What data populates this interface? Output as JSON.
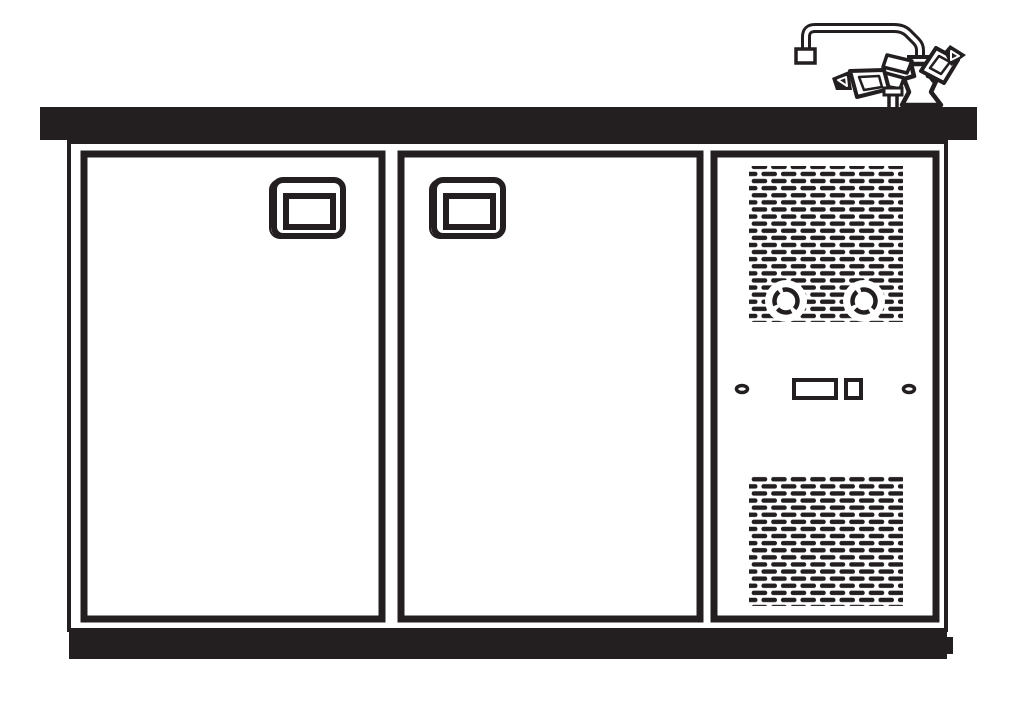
{
  "colors": {
    "ink": "#231f20",
    "paper": "#ffffff"
  },
  "components": {
    "diagram": "Technical line drawing of an under-counter back-bar cooler with sink faucet",
    "countertop": "Countertop",
    "faucet": "Gooseneck faucet with cross handles",
    "cabinet": "Cooler cabinet frame",
    "left_door": "Left cooler door",
    "left_door_handle": "Recessed door handle",
    "right_door": "Right cooler door",
    "right_door_handle": "Recessed door handle",
    "compressor_panel": "Compressor compartment front panel",
    "top_grille": "Upper ventilation grille",
    "knob_left": "Left control knob",
    "knob_right": "Right control knob",
    "screw_left": "Left panel screw",
    "screw_right": "Right panel screw",
    "display_window": "Indicator window",
    "switch": "Toggle switch",
    "bottom_grille": "Lower ventilation grille",
    "plinth": "Base plinth"
  }
}
